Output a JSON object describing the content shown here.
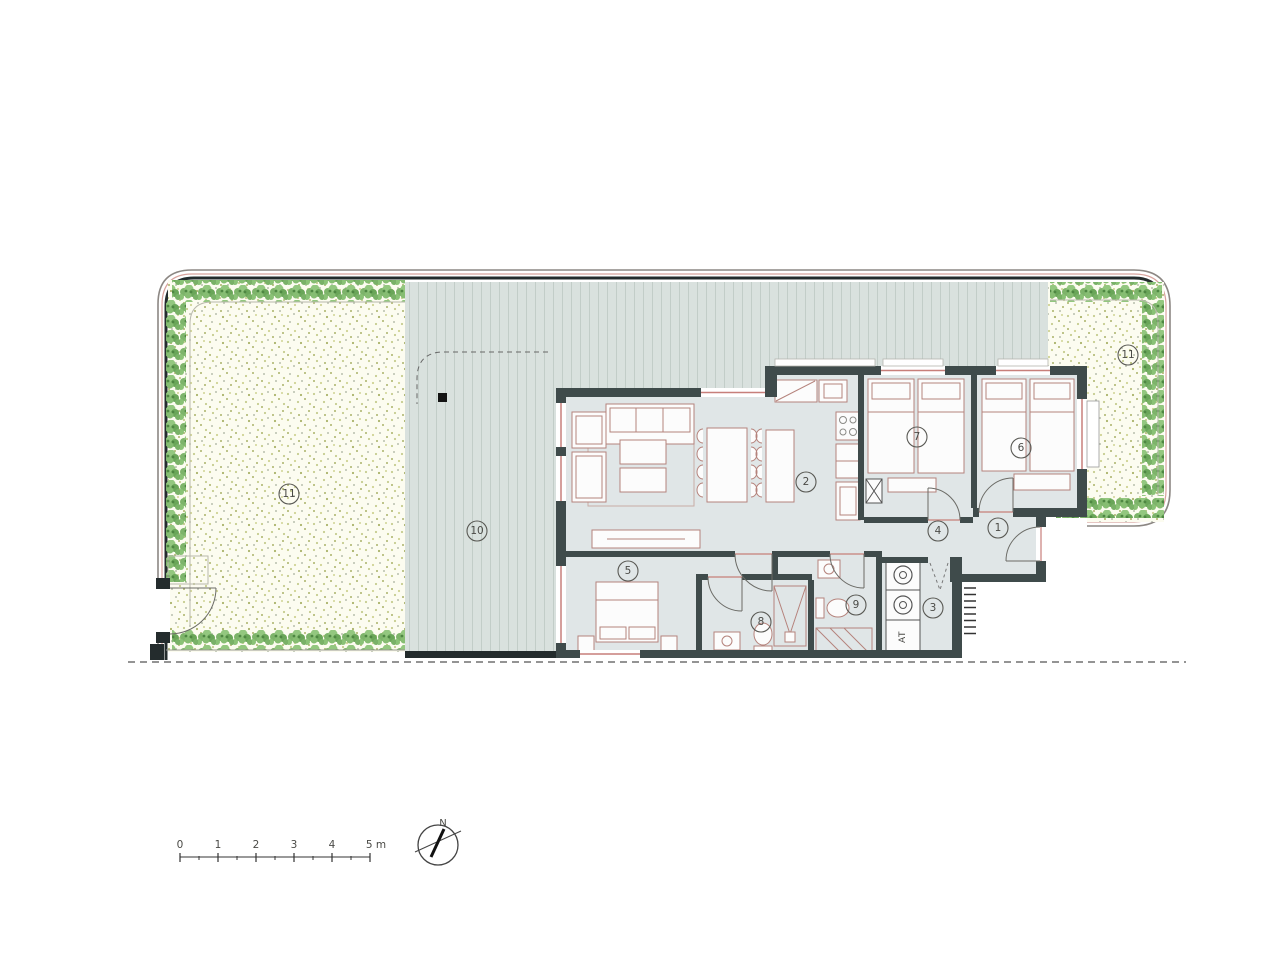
{
  "rooms": {
    "entry": "1",
    "living": "2",
    "utility": "3",
    "hall": "4",
    "bedroom_main": "5",
    "bedroom_2": "6",
    "bedroom_3": "7",
    "bath_main": "8",
    "bath_2": "9",
    "deck": "10",
    "garden_left": "11",
    "garden_right": "11"
  },
  "fixtures": {
    "water_heater_label": "AT"
  },
  "scale_bar": {
    "labels": [
      "0",
      "1",
      "2",
      "3",
      "4",
      "5 m"
    ]
  },
  "compass": {
    "north_label": "N"
  },
  "colors": {
    "wall": "#3f4b4b",
    "floor": "#e0e6e7",
    "deck": "#d9e1de",
    "deck_stripe": "#c2cdc8",
    "garden": "#fcfcf0",
    "stipple_olive": "#aab269",
    "hedge": "#7db46a",
    "window_accent": "#c77f7a",
    "boundary_accent": "#d8a39d",
    "boundary_dark": "#242c2d",
    "ink": "#4a4a46"
  }
}
